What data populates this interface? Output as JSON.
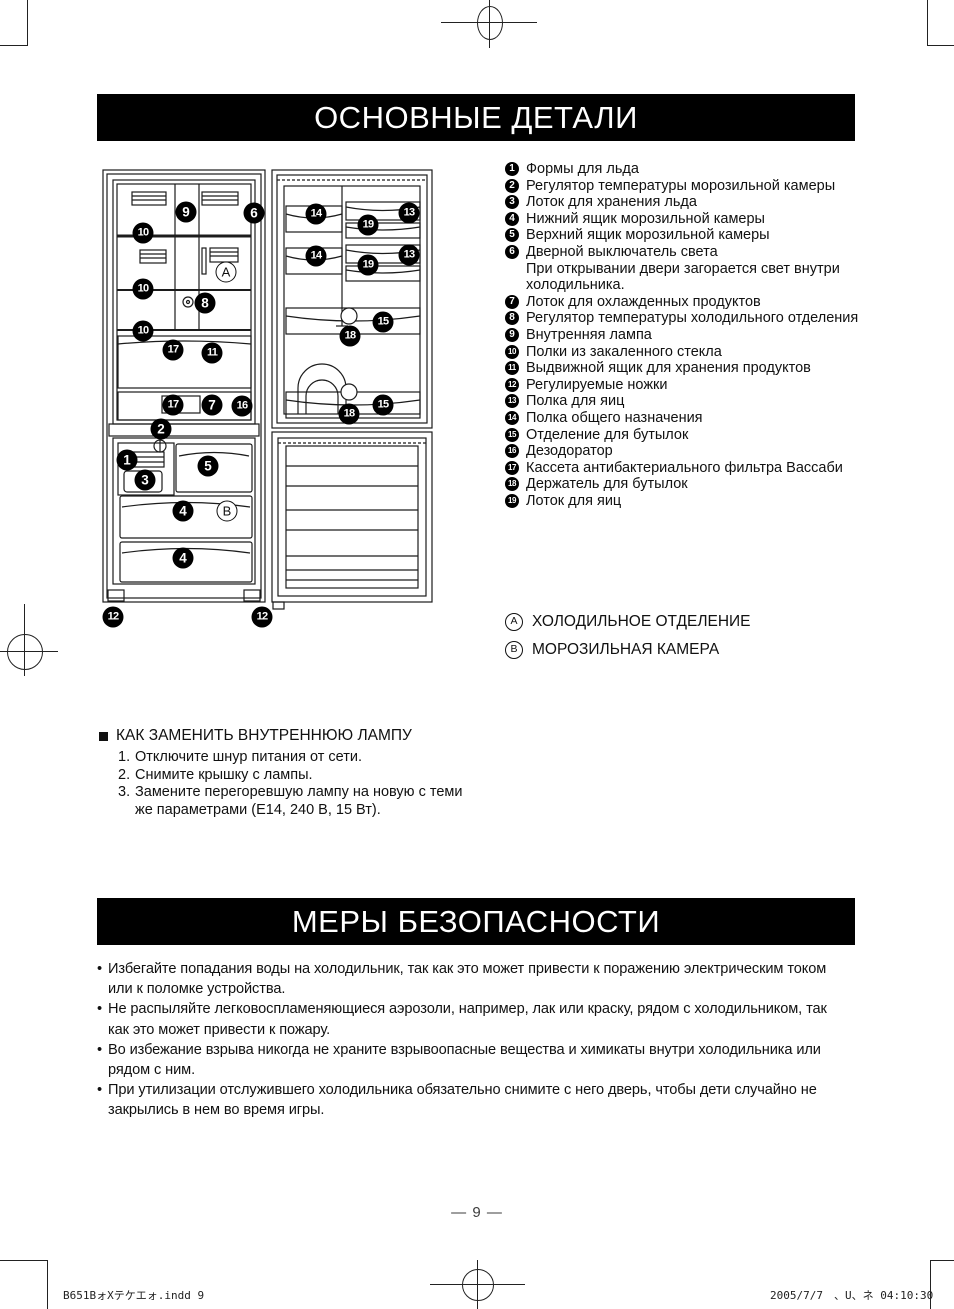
{
  "headers": {
    "parts_title": "ОСНОВНЫЕ ДЕТАЛИ",
    "safety_title": "МЕРЫ БЕЗОПАСНОСТИ"
  },
  "parts_list": [
    {
      "num": "1",
      "text": "Формы для льда"
    },
    {
      "num": "2",
      "text": "Регулятор температуры морозильной камеры"
    },
    {
      "num": "3",
      "text": "Лоток для хранения льда"
    },
    {
      "num": "4",
      "text": "Нижний ящик морозильной камеры"
    },
    {
      "num": "5",
      "text": "Верхний ящик морозильной камеры"
    },
    {
      "num": "6",
      "text": "Дверной выключатель света",
      "extra": "При открывании двери загорается свет внутри холодильника."
    },
    {
      "num": "7",
      "text": "Лоток для охлажденных продуктов"
    },
    {
      "num": "8",
      "text": "Регулятор температуры холодильного отделения"
    },
    {
      "num": "9",
      "text": "Внутренняя лампа"
    },
    {
      "num": "10",
      "text": "Полки из закаленного стекла"
    },
    {
      "num": "11",
      "text": "Выдвижной ящик для хранения продуктов"
    },
    {
      "num": "12",
      "text": "Регулируемые ножки"
    },
    {
      "num": "13",
      "text": "Полка для яиц"
    },
    {
      "num": "14",
      "text": "Полка общего назначения"
    },
    {
      "num": "15",
      "text": "Отделение для бутылок"
    },
    {
      "num": "16",
      "text": "Дезодоратор"
    },
    {
      "num": "17",
      "text": "Кассета антибактериального фильтра Вассаби"
    },
    {
      "num": "18",
      "text": "Держатель для бутылок"
    },
    {
      "num": "19",
      "text": "Лоток для яиц"
    }
  ],
  "legend": [
    {
      "letter": "A",
      "text": "ХОЛОДИЛЬНОЕ ОТДЕЛЕНИЕ"
    },
    {
      "letter": "B",
      "text": "МОРОЗИЛЬНАЯ КАМЕРА"
    }
  ],
  "lamp": {
    "title": "КАК ЗАМЕНИТЬ ВНУТРЕННЮЮ ЛАМПУ",
    "steps": [
      {
        "num": "1.",
        "text": "Отключите шнур питания от сети."
      },
      {
        "num": "2.",
        "text": "Снимите крышку с лампы."
      },
      {
        "num": "3.",
        "text": "Замените перегоревшую лампу на новую с теми же параметрами (E14, 240 В, 15 Вт)."
      }
    ]
  },
  "safety_items": [
    {
      "bullet": "•",
      "text": "Избегайте попадания воды на холодильник, так как это может привести к поражению электрическим током или к поломке устройства."
    },
    {
      "bullet": "•",
      "text": "Не распыляйте легковоспламеняющиеся аэрозоли, например, лак или краску, рядом с холодильником, так как это может привести к пожару."
    },
    {
      "bullet": "•",
      "text": "Во избежание взрыва никогда не храните взрывоопасные вещества и химикаты внутри холодильника или рядом с ним."
    },
    {
      "bullet": "•",
      "text": "При утилизации отслужившего холодильника обязательно снимите с него дверь, чтобы дети случайно не закрылись в нем во время игры."
    }
  ],
  "page": {
    "page_label": "— 9 —",
    "footer_left": "B651BォXテケエォ.indd    9",
    "footer_right": "2005/7/7　、U、ネ 04:10:30"
  },
  "diagram": {
    "callouts": [
      {
        "label": "9",
        "x": 186,
        "y": 212,
        "type": "filled"
      },
      {
        "label": "6",
        "x": 254,
        "y": 213,
        "type": "filled"
      },
      {
        "label": "10",
        "x": 143,
        "y": 233,
        "type": "filled"
      },
      {
        "label": "A",
        "x": 226,
        "y": 272,
        "type": "outline"
      },
      {
        "label": "10",
        "x": 143,
        "y": 289,
        "type": "filled"
      },
      {
        "label": "8",
        "x": 205,
        "y": 303,
        "type": "filled"
      },
      {
        "label": "10",
        "x": 143,
        "y": 331,
        "type": "filled"
      },
      {
        "label": "17",
        "x": 173,
        "y": 350,
        "type": "filled"
      },
      {
        "label": "11",
        "x": 212,
        "y": 353,
        "type": "filled"
      },
      {
        "label": "17",
        "x": 173,
        "y": 405,
        "type": "filled"
      },
      {
        "label": "7",
        "x": 212,
        "y": 405,
        "type": "filled"
      },
      {
        "label": "16",
        "x": 242,
        "y": 406,
        "type": "filled"
      },
      {
        "label": "2",
        "x": 161,
        "y": 429,
        "type": "filled"
      },
      {
        "label": "1",
        "x": 127,
        "y": 460,
        "type": "filled"
      },
      {
        "label": "5",
        "x": 208,
        "y": 466,
        "type": "filled"
      },
      {
        "label": "3",
        "x": 145,
        "y": 480,
        "type": "filled"
      },
      {
        "label": "4",
        "x": 183,
        "y": 511,
        "type": "filled"
      },
      {
        "label": "B",
        "x": 227,
        "y": 511,
        "type": "outline"
      },
      {
        "label": "4",
        "x": 183,
        "y": 558,
        "type": "filled"
      },
      {
        "label": "12",
        "x": 113,
        "y": 617,
        "type": "filled"
      },
      {
        "label": "12",
        "x": 262,
        "y": 617,
        "type": "filled"
      },
      {
        "label": "14",
        "x": 316,
        "y": 214,
        "type": "filled"
      },
      {
        "label": "19",
        "x": 368,
        "y": 225,
        "type": "filled"
      },
      {
        "label": "13",
        "x": 409,
        "y": 213,
        "type": "filled"
      },
      {
        "label": "14",
        "x": 316,
        "y": 256,
        "type": "filled"
      },
      {
        "label": "19",
        "x": 368,
        "y": 265,
        "type": "filled"
      },
      {
        "label": "13",
        "x": 409,
        "y": 255,
        "type": "filled"
      },
      {
        "label": "15",
        "x": 383,
        "y": 322,
        "type": "filled"
      },
      {
        "label": "18",
        "x": 350,
        "y": 336,
        "type": "filled"
      },
      {
        "label": "15",
        "x": 383,
        "y": 405,
        "type": "filled"
      },
      {
        "label": "18",
        "x": 349,
        "y": 414,
        "type": "filled"
      }
    ]
  }
}
